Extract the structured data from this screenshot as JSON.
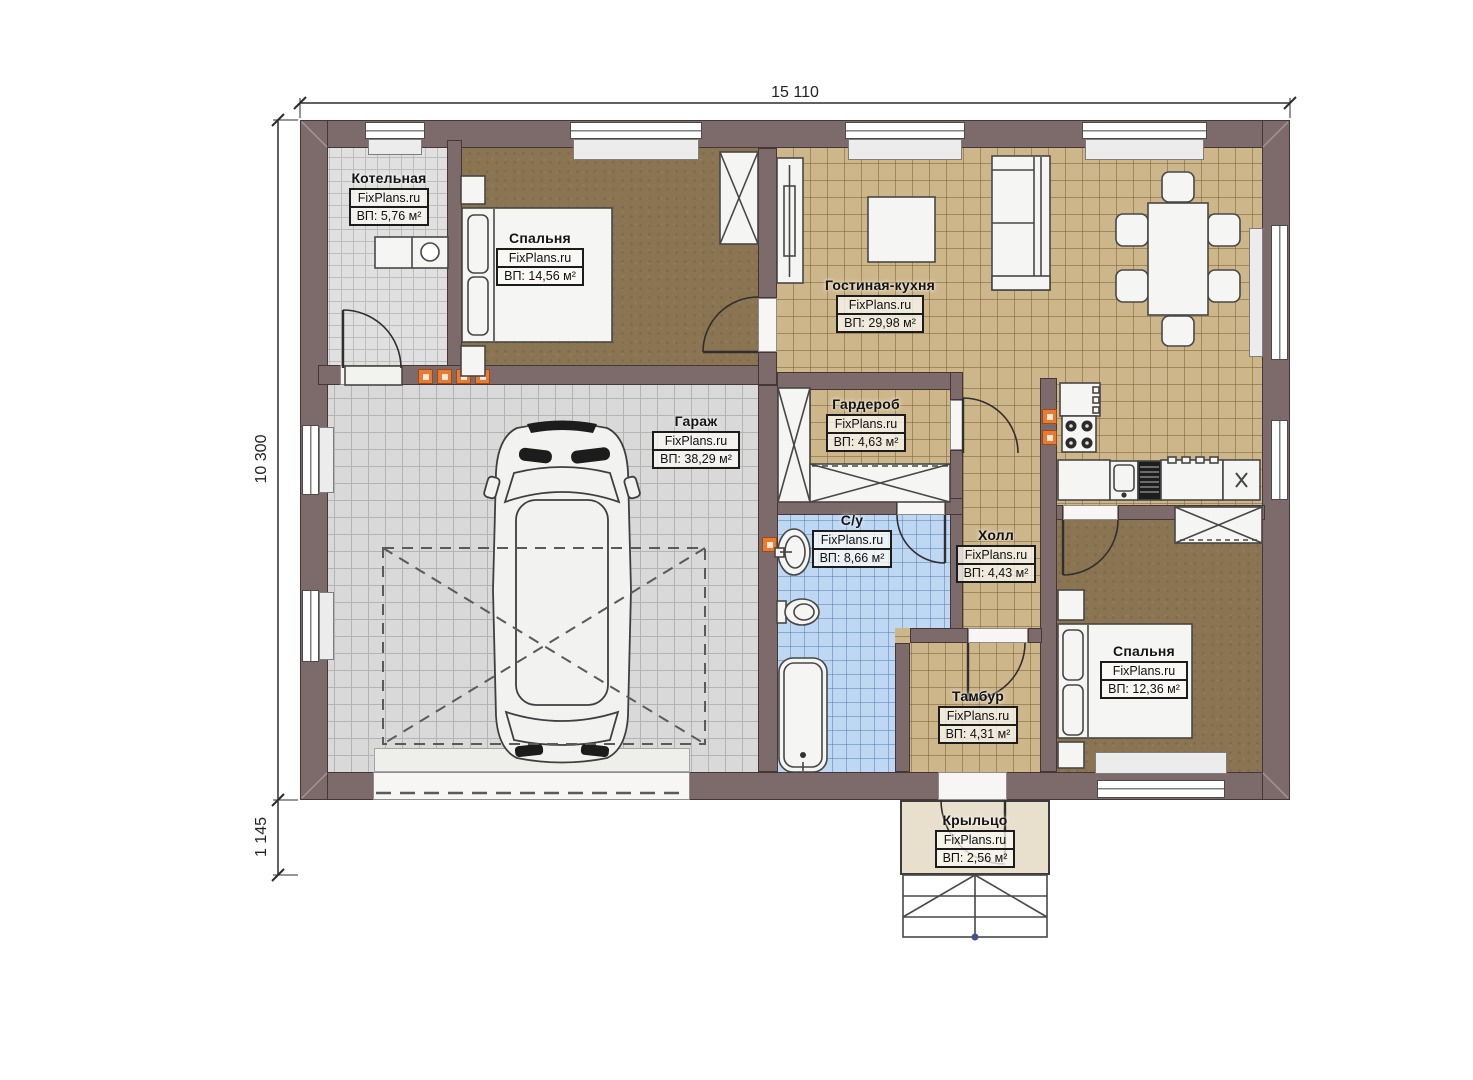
{
  "watermark": "FixPlans.ru",
  "dimensions": {
    "width_top": "15 110",
    "height_left": "10 300",
    "porch_left": "1 145"
  },
  "rooms": [
    {
      "name": "Котельная",
      "brand": "FixPlans.ru",
      "area": "ВП: 5,76 м²"
    },
    {
      "name": "Спальня",
      "brand": "FixPlans.ru",
      "area": "ВП: 14,56 м²"
    },
    {
      "name": "Гостиная-кухня",
      "brand": "FixPlans.ru",
      "area": "ВП: 29,98 м²"
    },
    {
      "name": "Гараж",
      "brand": "FixPlans.ru",
      "area": "ВП: 38,29 м²"
    },
    {
      "name": "Гардероб",
      "brand": "FixPlans.ru",
      "area": "ВП: 4,63 м²"
    },
    {
      "name": "С/у",
      "brand": "FixPlans.ru",
      "area": "ВП: 8,66 м²"
    },
    {
      "name": "Холл",
      "brand": "FixPlans.ru",
      "area": "ВП: 4,43 м²"
    },
    {
      "name": "Тамбур",
      "brand": "FixPlans.ru",
      "area": "ВП: 4,31 м²"
    },
    {
      "name": "Спальня",
      "brand": "FixPlans.ru",
      "area": "ВП: 12,36 м²"
    },
    {
      "name": "Крыльцо",
      "brand": "FixPlans.ru",
      "area": "ВП: 2,56 м²"
    }
  ],
  "colors": {
    "wall": "#7d6a6b",
    "wall_outline": "#453637",
    "floor_living": "#cdb68a",
    "floor_garage": "#d9d9d9",
    "floor_boiler": "#e0e0e0",
    "floor_bedroom": "#8a7452",
    "floor_bath": "#bed8f3",
    "floor_porch": "#e8dfcc",
    "accent_orange": "#e87a33"
  }
}
